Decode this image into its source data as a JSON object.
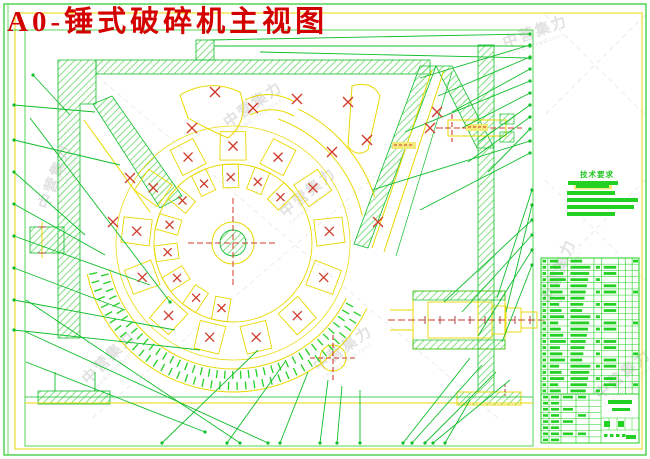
{
  "title": "A0-锤式破碎机主视图",
  "tech_requirements": {
    "heading": "技术要求"
  },
  "watermark": {
    "text": "中营集力",
    "subtext": "ZHONGYINGJULI"
  },
  "colors": {
    "frame_green": "#44d044",
    "line_green": "#0fbe2a",
    "hatch_green": "#6fdc6f",
    "bar_green": "#22d122",
    "yellow": "#e9d800",
    "red": "#cf3a2a",
    "dark_red": "#a84444",
    "title_red": "#d40000",
    "watermark_gray": "#9a9a9a"
  },
  "parts_table": {
    "rows": 22,
    "columns": 8
  },
  "title_block": {
    "sign_rows": 8
  }
}
